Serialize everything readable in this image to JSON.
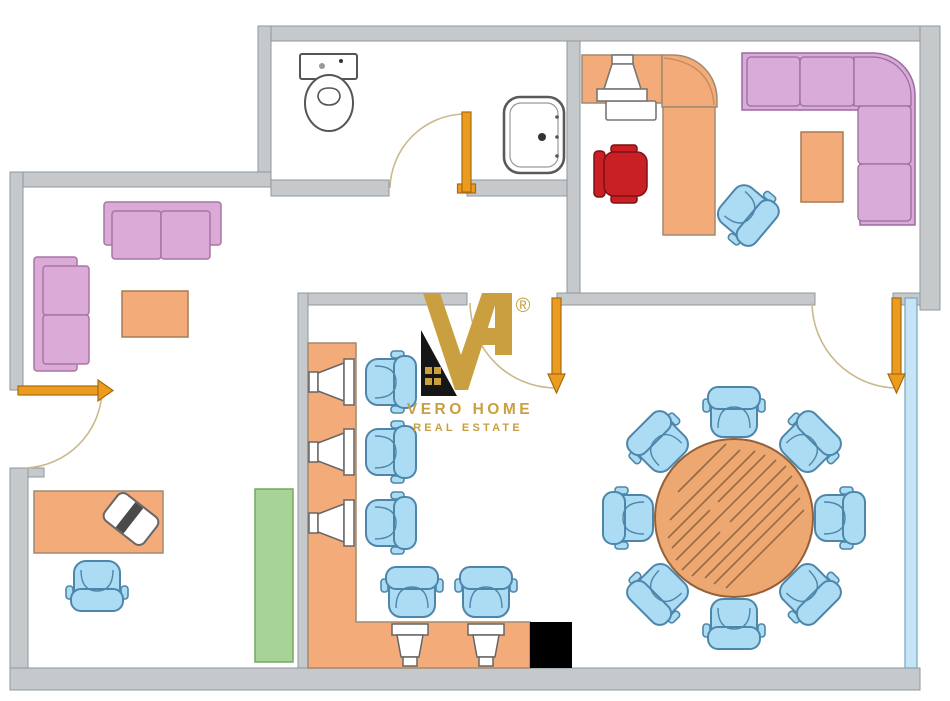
{
  "brand": {
    "name_line1": "VERO HOME",
    "name_line2": "REAL ESTATE",
    "registered_mark": "®",
    "logo_gold": "#c99f3f",
    "logo_black": "#161616"
  },
  "palette": {
    "wall_fill": "#c5c9cb",
    "wall_stroke": "#8e979c",
    "wood_orange": "#f2ab79",
    "sofa_pink": "#dcaad6",
    "sectional_pink": "#d9abd9",
    "chair_blue": "#abdcf4",
    "chair_blue_stroke": "#4d86aa",
    "office_chair_red": "#c92026",
    "cabinet_green": "#a7d396",
    "door_orange": "#eb9b1e",
    "door_swing_arc": "#c9b98b",
    "window_glass_blue": "#c5e5f6",
    "round_table_wood": "#eda771",
    "pillar_black": "#000000"
  },
  "floor_plan": {
    "type": "office-floor-plan",
    "rooms": [
      {
        "name": "lounge",
        "furniture": [
          "two-seat-sofa-horizontal",
          "two-seat-sofa-vertical",
          "coffee-table"
        ]
      },
      {
        "name": "bathroom",
        "furniture": [
          "toilet",
          "wash-basin"
        ]
      },
      {
        "name": "private-office",
        "furniture": [
          "l-shaped-desk",
          "desktop-monitor",
          "red-executive-chair",
          "blue-guest-chair",
          "corner-sectional-sofa",
          "side-table"
        ]
      },
      {
        "name": "workstation-area",
        "furniture": [
          "l-shaped-counter",
          "monitor-1",
          "monitor-2",
          "monitor-3",
          "monitor-4",
          "monitor-5",
          "blue-task-chair-1",
          "blue-task-chair-2",
          "blue-task-chair-3",
          "blue-task-chair-4",
          "blue-task-chair-5",
          "black-pillar",
          "green-cabinet"
        ]
      },
      {
        "name": "meeting-area",
        "furniture": [
          "round-conference-table",
          "blue-chair-x8"
        ],
        "window": "full-height-glazing-right"
      },
      {
        "name": "reception-office",
        "furniture": [
          "desk",
          "laptop",
          "blue-task-chair"
        ]
      }
    ],
    "doors": [
      {
        "name": "entrance-door-left",
        "swing": "into-plan",
        "arrow": "right"
      },
      {
        "name": "bathroom-door",
        "swing": "into-bathroom",
        "arrow": "up"
      },
      {
        "name": "corridor-door",
        "swing": "into-open-space",
        "arrow": "down"
      },
      {
        "name": "private-office-door",
        "swing": "into-open-space",
        "arrow": "down"
      }
    ],
    "window_count": 1,
    "seat_count_meeting_table": 8
  }
}
